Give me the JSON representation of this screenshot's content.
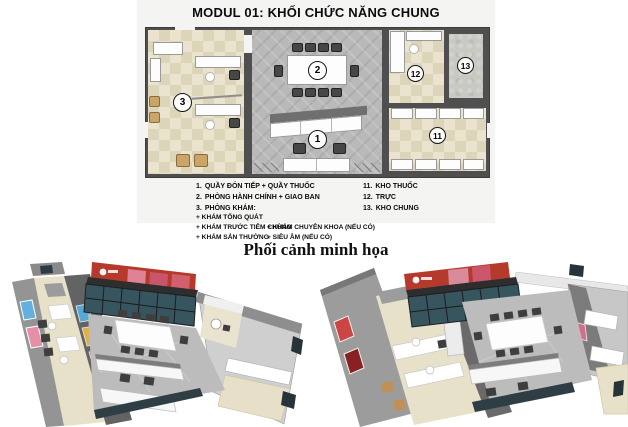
{
  "title": "MODUL 01: KHỐI CHỨC NĂNG CHUNG",
  "caption": "Phối cảnh minh họa",
  "floorplan": {
    "room_numbers": [
      "1",
      "2",
      "3",
      "11",
      "12",
      "13"
    ]
  },
  "legend": {
    "left": [
      {
        "num": "1.",
        "text": "QUẦY ĐÓN TIẾP + QUẦY THUỐC"
      },
      {
        "num": "2.",
        "text": "PHÒNG HÀNH CHÍNH + GIAO BAN"
      },
      {
        "num": "3.",
        "text": "PHÒNG KHÁM:"
      }
    ],
    "sub_rows": [
      {
        "col1": "+ KHÁM TỔNG QUÁT",
        "col2": ""
      },
      {
        "col1": "+ KHÁM TRƯỚC TIÊM CHỦNG",
        "col2": "+ KHÁM CHUYÊN KHOA (NẾU CÓ)"
      },
      {
        "col1": "+ KHÁM SẢN THƯỜNG",
        "col2": "+ SIÊU ÂM (NẾU CÓ)"
      }
    ],
    "right": [
      {
        "num": "11.",
        "text": "KHO THUỐC"
      },
      {
        "num": "12.",
        "text": "TRỰC"
      },
      {
        "num": "13.",
        "text": "KHO CHUNG"
      }
    ]
  },
  "colors": {
    "accent_red": "#b53a2c",
    "floor_beige": "#e8e1ca",
    "floor_gray": "#bcbcbc",
    "wall_gray": "#4f4f4f"
  }
}
